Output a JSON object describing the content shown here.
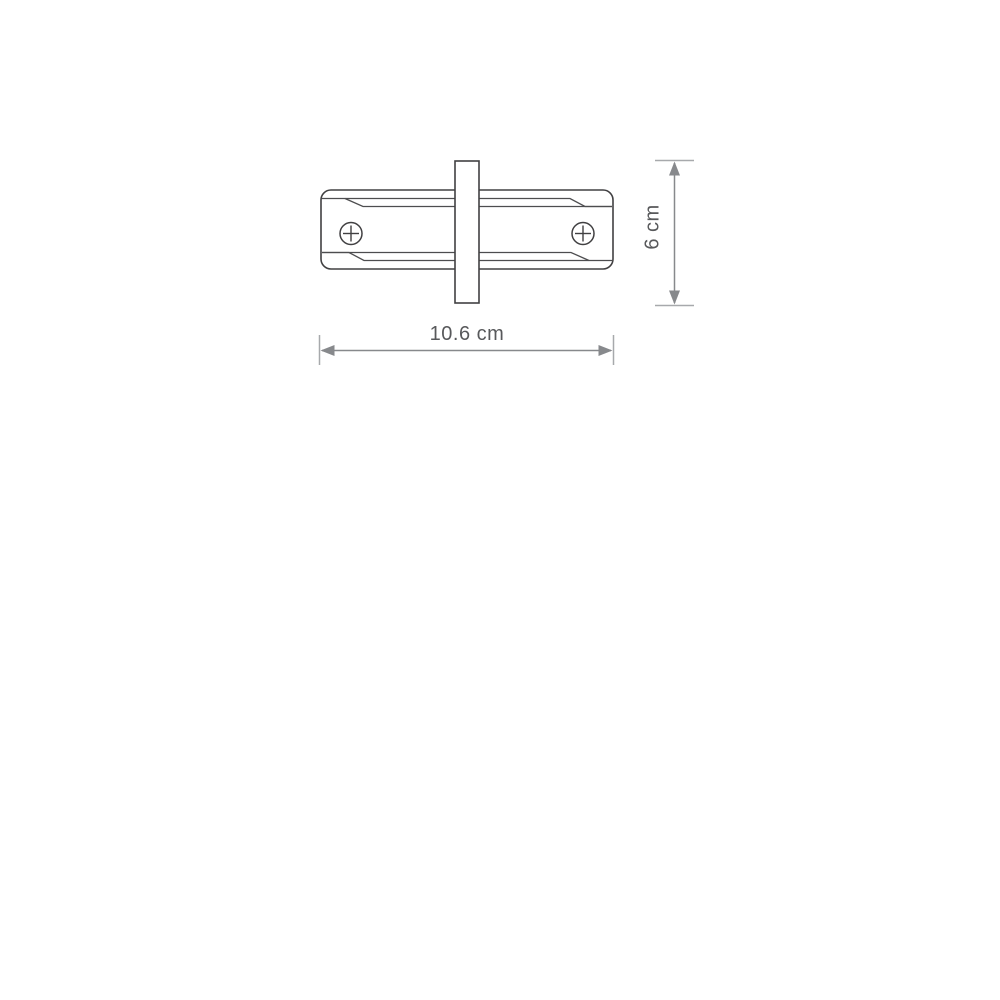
{
  "diagram": {
    "type": "technical-dimension-drawing",
    "dimensions": {
      "width": {
        "label": "10.6 cm",
        "value": "10.6",
        "unit": "cm"
      },
      "height": {
        "label": "6 cm",
        "value": "6",
        "unit": "cm"
      }
    },
    "icons": {
      "screw_left": "phillips-screw-icon",
      "screw_right": "phillips-screw-icon"
    },
    "colors": {
      "outline": "#414042",
      "detail_line": "#4d4d4f",
      "dimension_line": "#87898c",
      "dimension_cap": "#a7a9ac",
      "label_text": "#58595b",
      "fill": "#ffffff"
    }
  }
}
